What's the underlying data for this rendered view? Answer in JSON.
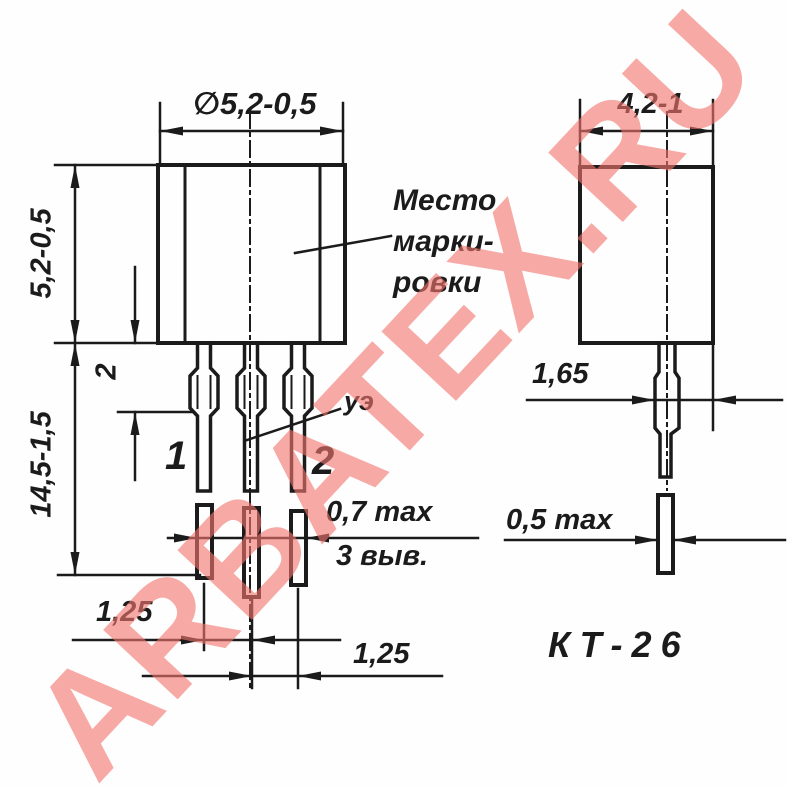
{
  "drawing_title": "КТ-26 transistor package outline drawing",
  "watermark": {
    "text": "ARBATEX.RU",
    "color": "#F2766E"
  },
  "front_view": {
    "dim_diameter": "∅5,2-0,5",
    "dim_body_height": "5,2-0,5",
    "dim_shoulder_length": "2",
    "dim_total_length": "14,5-1,5",
    "marking_note": [
      "Место",
      "марки-",
      "ровки"
    ],
    "emitter_label": "уэ",
    "lead1_label": "1",
    "lead2_label": "2",
    "dim_lead_width": "0,7 max",
    "leads_note": "3 выв.",
    "dim_pitch_left": "1,25",
    "dim_pitch_right": "1,25"
  },
  "side_view": {
    "dim_depth": "4,2-1",
    "dim_lead_offset": "1,65",
    "dim_lead_thickness": "0,5 max",
    "package_name": "КТ-26"
  },
  "colors": {
    "ink": "#1b1b1b",
    "background": "#fefefe",
    "watermark_pink": "#F6A8A0"
  }
}
